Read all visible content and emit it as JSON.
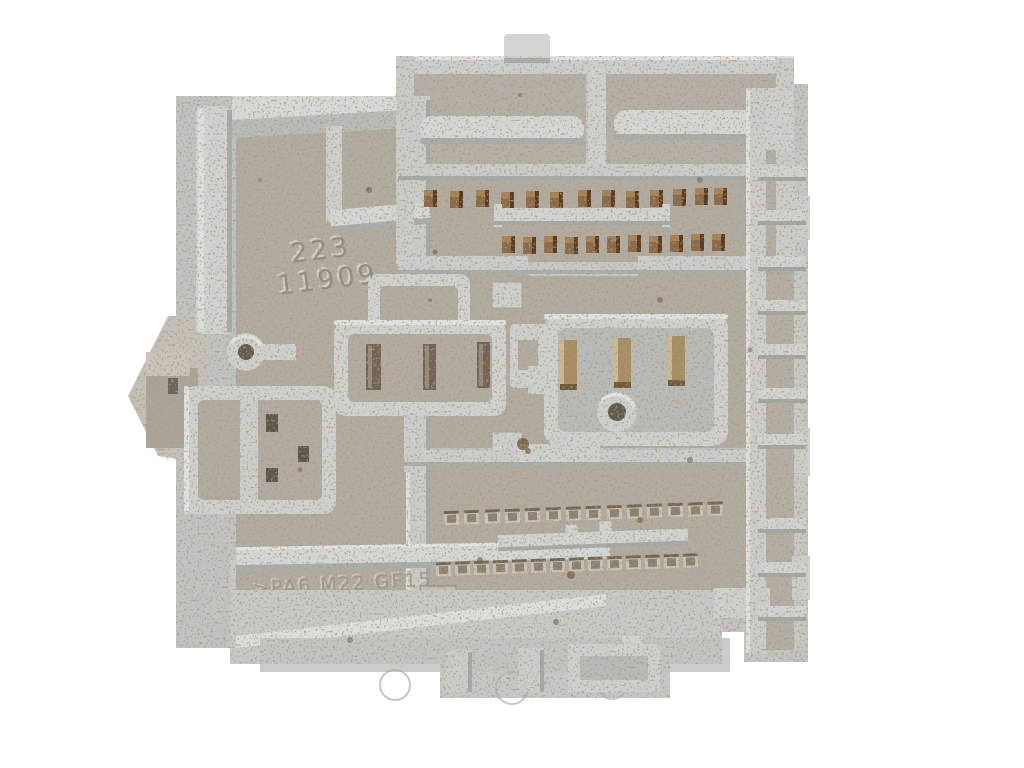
{
  "scene": {
    "description": "Top-down photograph of a used light-gray automotive fuse / relay junction box housing on a white background. The plastic body is dirty with brown speckles, and shows empty connector cavities, two relay sockets with blade terminals, two screw bosses, rows of bronze pins and square terminal sockets, and embossed mold markings.",
    "object": "automotive fuse box housing (underside)",
    "background_color": "#ffffff"
  },
  "markings": {
    "mold_number_line1": "223",
    "mold_number_line2": "11909",
    "material_code": ">PA6 M22 GF15"
  },
  "features": {
    "top_connector": {
      "pin_rows": 2,
      "pins_row1": 13,
      "pins_row2": 11
    },
    "bottom_connector": {
      "socket_rows": 2,
      "sockets_row1": 14,
      "sockets_row2": 14
    },
    "relay_sockets": 2,
    "blade_terminals_per_socket": 3,
    "screw_bosses": 2
  },
  "palette": {
    "plastic_light": "#d1d5d3",
    "plastic_mid": "#c1c5c4",
    "plastic_shadow": "#9aa09e",
    "floor_dirty": "#b2aca3",
    "highlight": "#e9ebe9",
    "dirt_brown": "#6f5334",
    "pin_bronze": "#8a6845",
    "terminal_brass": "#a88d62",
    "slot_dark": "#5a5348"
  }
}
